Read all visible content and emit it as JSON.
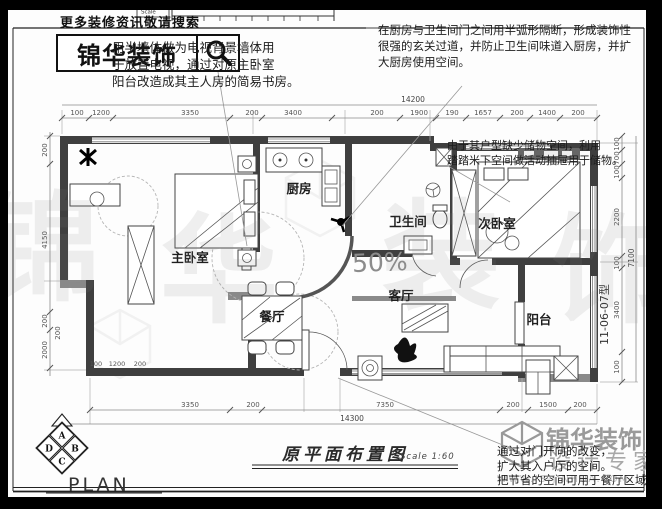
{
  "header": {
    "search_hint": "更多装修资讯敬请搜索",
    "brand": "锦华装饰",
    "scale_label": "Scale"
  },
  "annotations": {
    "tv_wall": "用半墙体做为电视背景墙体用\n于放置电视，通过对原主卧室\n阳台改造成其主人房的简易书房。",
    "arc_partition": "在厨房与卫生间门之间用半弧形隔断，形成装饰性\n很强的玄关过道，并防止卫生间味道入厨房，并扩\n大厨房使用空间。",
    "tatami_storage": "由于其户型缺少储物空间，利用\n踏踏米下空间做活动抽屉用于储物。",
    "entry_door": "通过对门开向的改变，\n扩大其入户厅的空间。\n把节省的空间可用于餐厅区域"
  },
  "rooms": {
    "master": "主卧室",
    "kitchen": "厨房",
    "bath": "卫生间",
    "second": "次卧室",
    "living": "客厅",
    "dining": "餐厅",
    "balcony": "阳台"
  },
  "dims": {
    "top_total": "14200",
    "top_segments": [
      "100",
      "1200",
      "3350",
      "200",
      "3400",
      "200",
      "1900",
      "190",
      "1657",
      "200",
      "1400",
      "200"
    ],
    "bottom_total": "14300",
    "bottom_segments": [
      "3350",
      "200",
      "7350",
      "200",
      "1500",
      "200"
    ],
    "left_segments": [
      "200",
      "4150",
      "200",
      "2000",
      "200"
    ],
    "left_inner": [
      "100",
      "1200",
      "200"
    ],
    "right_total": "7100",
    "right_segments": [
      "100",
      "700",
      "100",
      "2200",
      "100",
      "3400",
      "100"
    ]
  },
  "plan_label": {
    "caption": "原平面布置图",
    "scale": "Scale 1:60",
    "plan": "PLAN",
    "unit_type": "11-06-07型",
    "percent": "50%"
  },
  "compass": {
    "top": "A",
    "right": "B",
    "bottom": "C",
    "left": "D"
  },
  "brand_footer": {
    "name": "锦华装饰",
    "tagline": "设计专家",
    "website": "WWW.JS-JINHUA.COM"
  },
  "watermark_chars": [
    "锦",
    "华",
    "装",
    "饰"
  ],
  "colors": {
    "wall": "#3f3f3f",
    "dim_line": "#8a8a8a",
    "text": "#1c1c1c",
    "watermark": "#d9d9d9"
  }
}
